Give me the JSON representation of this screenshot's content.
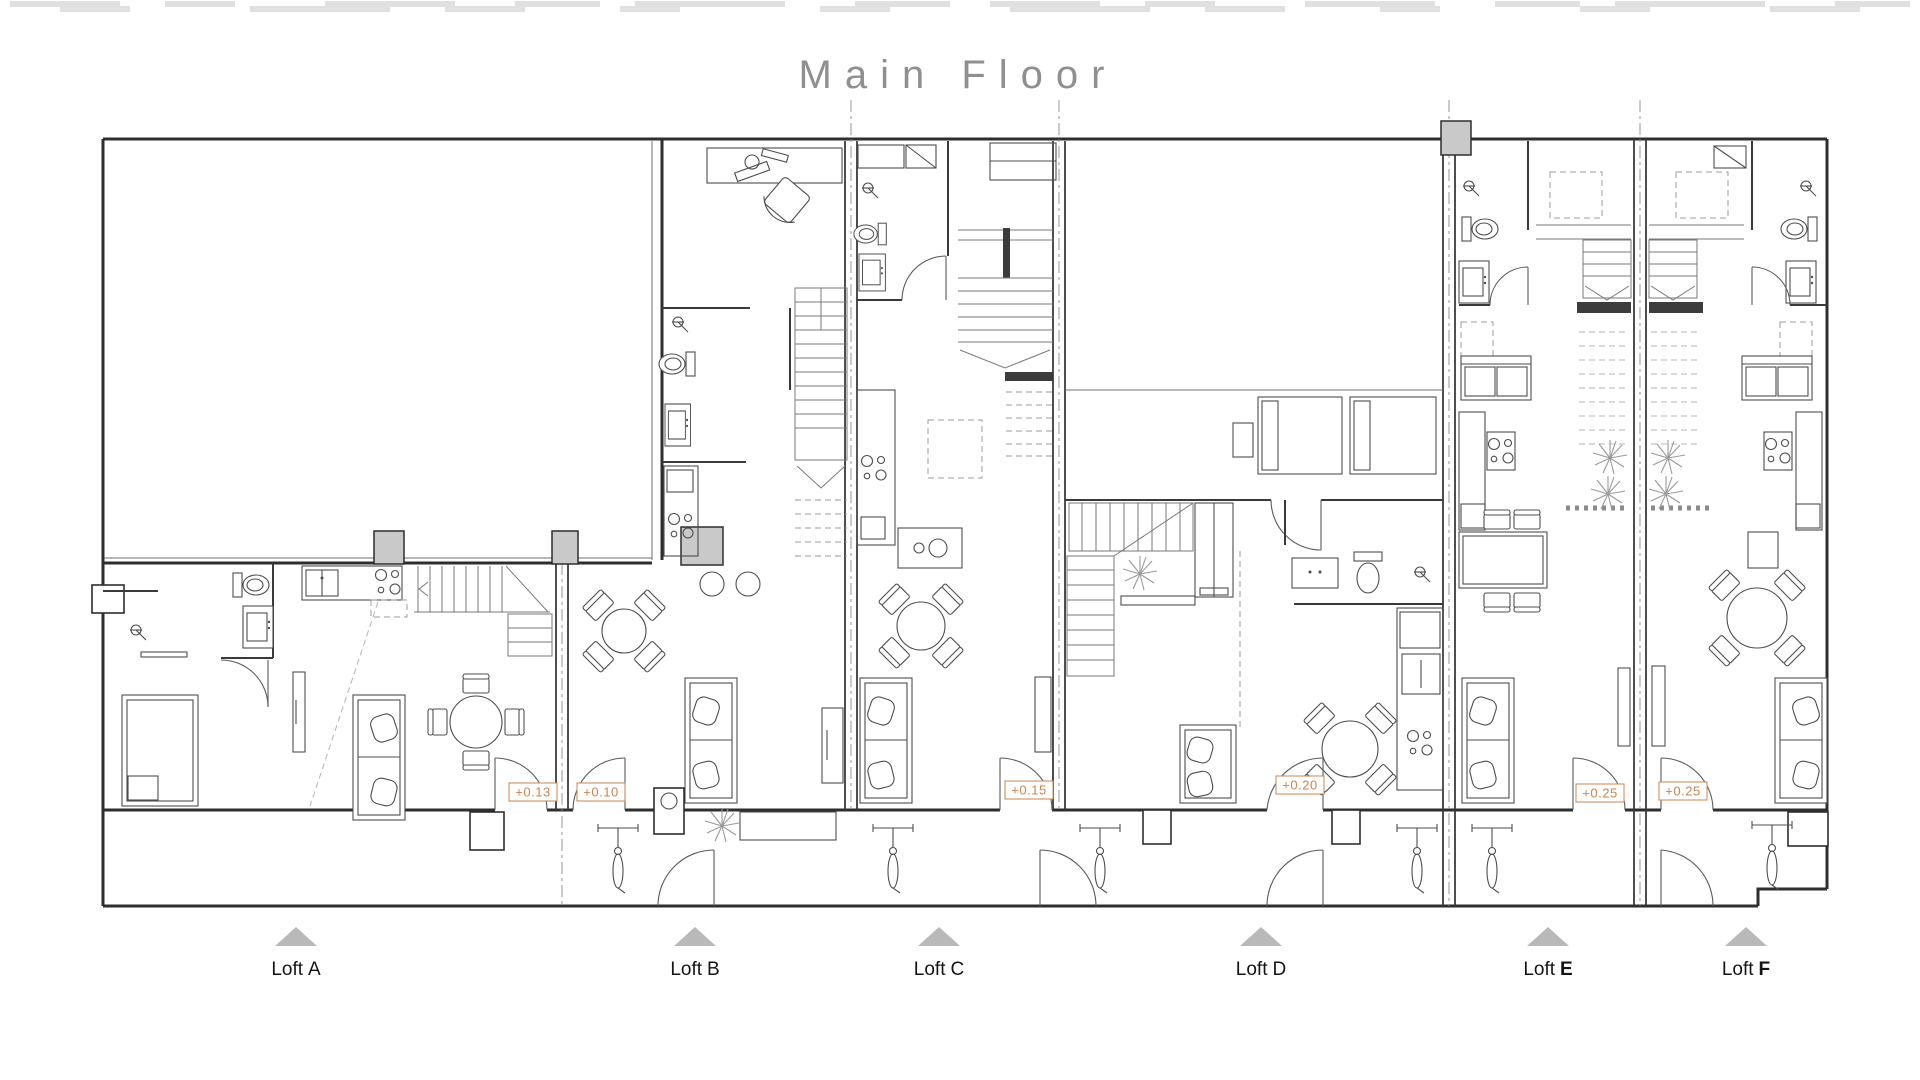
{
  "title": "Main Floor",
  "units": [
    {
      "prefix": "Loft",
      "letter": "A",
      "weight": "400"
    },
    {
      "prefix": "Loft",
      "letter": "B",
      "weight": "400"
    },
    {
      "prefix": "Loft",
      "letter": "C",
      "weight": "400"
    },
    {
      "prefix": "Loft",
      "letter": "D",
      "weight": "400"
    },
    {
      "prefix": "Loft",
      "letter": "E",
      "weight": "700"
    },
    {
      "prefix": "Loft",
      "letter": "F",
      "weight": "700"
    }
  ],
  "elevation_markers": [
    {
      "value": "+0.13"
    },
    {
      "value": "+0.10"
    },
    {
      "value": "+0.15"
    },
    {
      "value": "+0.20"
    },
    {
      "value": "+0.25"
    },
    {
      "value": "+0.25"
    }
  ],
  "colors": {
    "wall": "#2e2e2e",
    "furniture": "#4d4d4d",
    "dashed_axis": "#8a8a8a",
    "accent_marker": "#c8854f",
    "title": "#8f8f8f",
    "label": "#141414",
    "triangle": "#b9b9b9"
  }
}
